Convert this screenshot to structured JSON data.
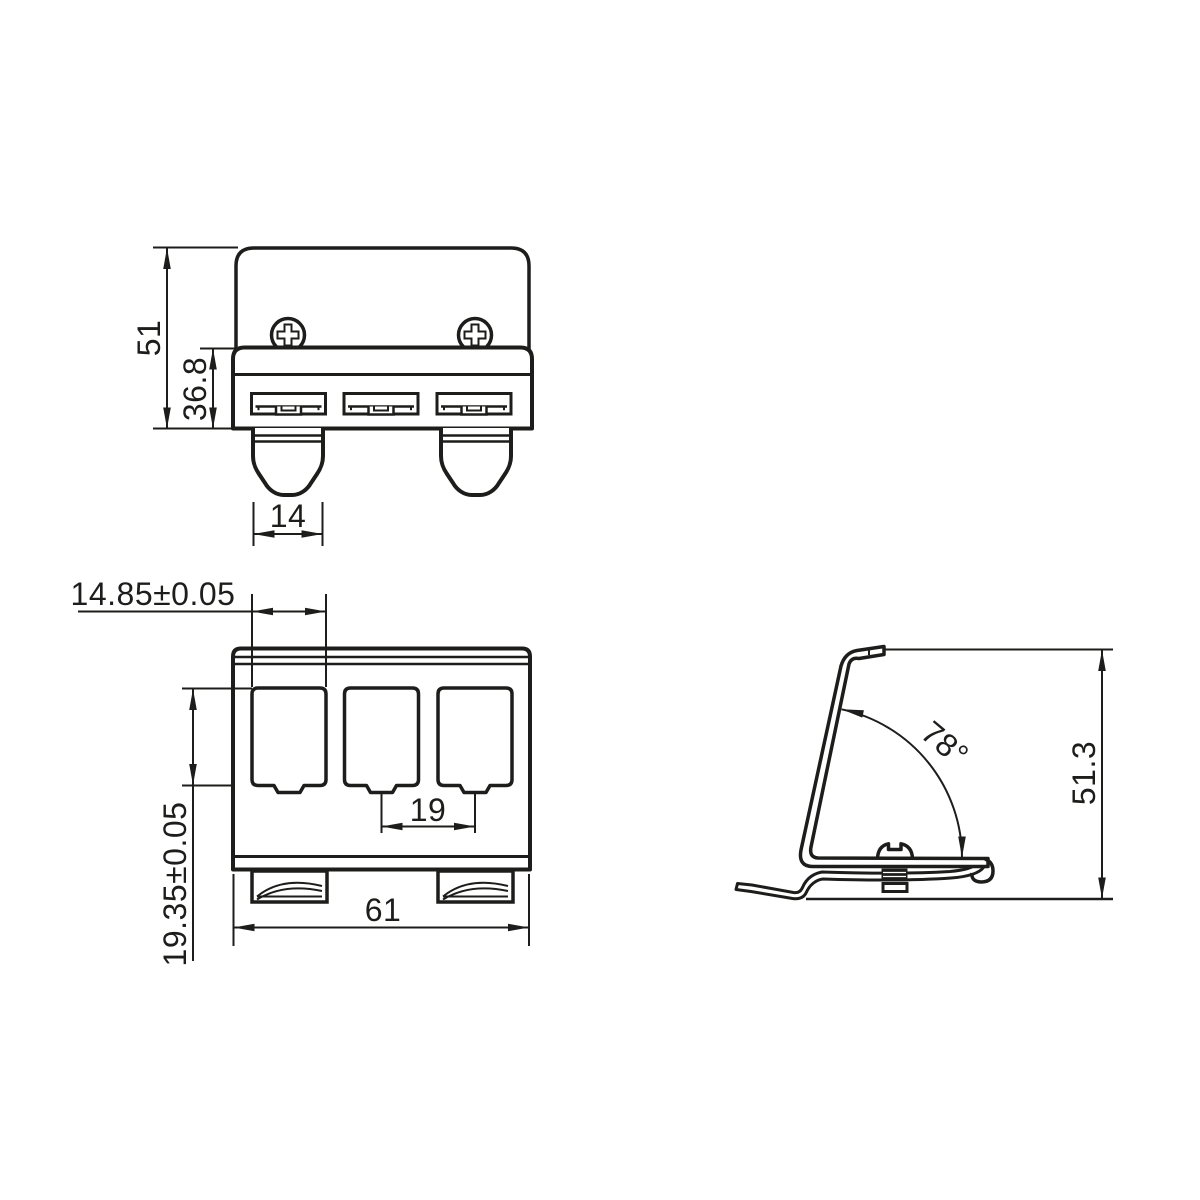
{
  "page": {
    "background": "#ffffff",
    "line_color": "#1d1d1b",
    "description": "Technical dimension drawing, three orthographic views of a DIN-rail keystone module holder"
  },
  "views": {
    "top": {
      "name": "top-view",
      "dims": {
        "total_depth": "51",
        "lower_depth": "36.8",
        "latch_width": "14"
      }
    },
    "front": {
      "name": "front-view",
      "dims": {
        "opening_width": "14.85±0.05",
        "opening_height": "19.35±0.05",
        "opening_pitch": "19",
        "overall_width": "61"
      }
    },
    "side": {
      "name": "side-view",
      "dims": {
        "angle": "78°",
        "overall_height": "51.3"
      }
    }
  }
}
